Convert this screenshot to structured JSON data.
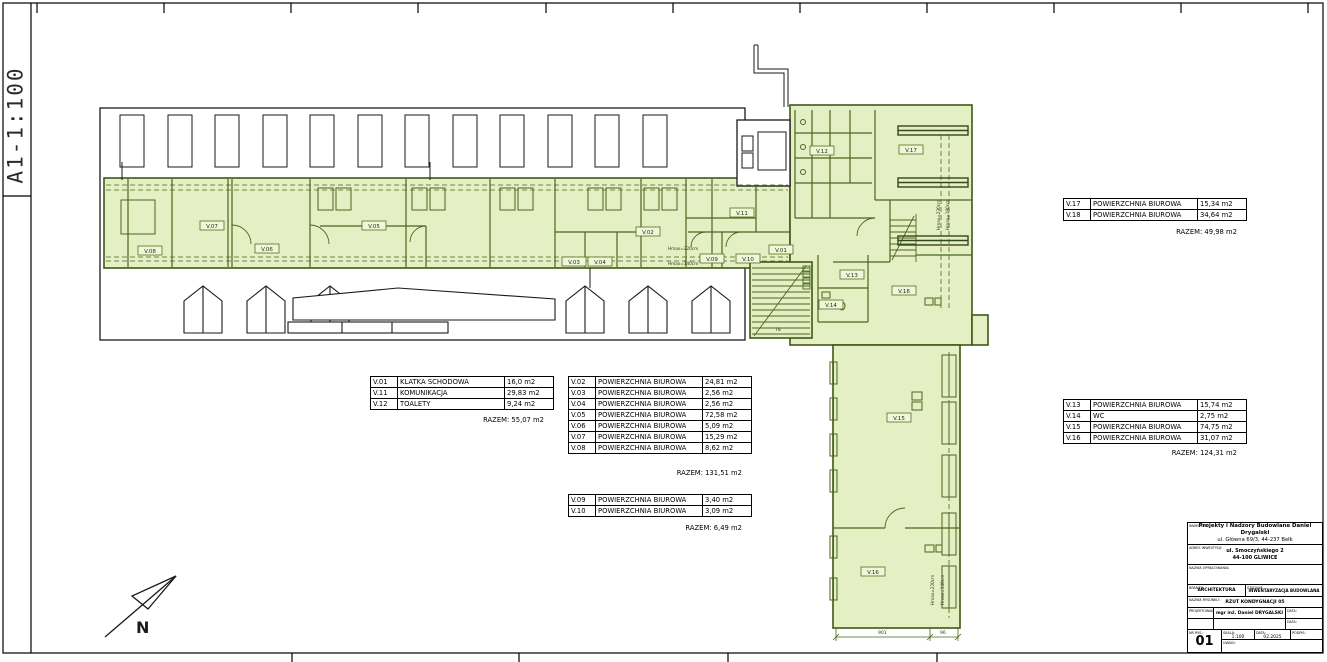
{
  "sheet": {
    "format_scale_label": "A1-1:100"
  },
  "plan": {
    "north_label": "N",
    "colors": {
      "room_fill": "#e5efc4",
      "plan_line": "#4a661e",
      "wall": "#1a1a1a"
    },
    "rooms": {
      "v01": "V.01",
      "v02": "V.02",
      "v03": "V.03",
      "v04": "V.04",
      "v05": "V.05",
      "v06": "V.06",
      "v07": "V.07",
      "v08": "V.08",
      "v09": "V.09",
      "v10": "V.10",
      "v11": "V.11",
      "v12": "V.12",
      "v13": "V.13",
      "v14": "V.14",
      "v15": "V.15",
      "v16": "V.16",
      "v17": "V.17",
      "v18": "V.18"
    },
    "annotations": {
      "h220": "Hmax=220cm",
      "h140": "Hmax=140cm",
      "h230": "Hmax=230cm",
      "h190": "Hmax=190cm"
    },
    "dimensions": {
      "stair_width": "78",
      "strip_bottom_main": "901",
      "strip_bottom_side": "96"
    }
  },
  "tables": {
    "t1": {
      "rows": [
        {
          "code": "V.01",
          "name": "KLATKA SCHODOWA",
          "area": "16,0 m2"
        },
        {
          "code": "V.11",
          "name": "KOMUNIKACJA",
          "area": "29,83 m2"
        },
        {
          "code": "V.12",
          "name": "TOALETY",
          "area": "9,24 m2"
        }
      ],
      "total": "RAZEM: 55,07 m2"
    },
    "t2": {
      "rows": [
        {
          "code": "V.02",
          "name": "POWIERZCHNIA BIUROWA",
          "area": "24,81 m2"
        },
        {
          "code": "V.03",
          "name": "POWIERZCHNIA BIUROWA",
          "area": "2,56 m2"
        },
        {
          "code": "V.04",
          "name": "POWIERZCHNIA BIUROWA",
          "area": "2,56 m2"
        },
        {
          "code": "V.05",
          "name": "POWIERZCHNIA BIUROWA",
          "area": "72,58 m2"
        },
        {
          "code": "V.06",
          "name": "POWIERZCHNIA BIUROWA",
          "area": "5,09 m2"
        },
        {
          "code": "V.07",
          "name": "POWIERZCHNIA BIUROWA",
          "area": "15,29 m2"
        },
        {
          "code": "V.08",
          "name": "POWIERZCHNIA BIUROWA",
          "area": "8,62 m2"
        }
      ],
      "total": "RAZEM: 131,51 m2"
    },
    "t3": {
      "rows": [
        {
          "code": "V.09",
          "name": "POWIERZCHNIA BIUROWA",
          "area": "3,40 m2"
        },
        {
          "code": "V.10",
          "name": "POWIERZCHNIA BIUROWA",
          "area": "3,09 m2"
        }
      ],
      "total": "RAZEM: 6,49 m2"
    },
    "t4": {
      "rows": [
        {
          "code": "V.17",
          "name": "POWIERZCHNIA BIUROWA",
          "area": "15,34 m2"
        },
        {
          "code": "V.18",
          "name": "POWIERZCHNIA BIUROWA",
          "area": "34,64 m2"
        }
      ],
      "total": "RAZEM: 49,98 m2"
    },
    "t5": {
      "rows": [
        {
          "code": "V.13",
          "name": "POWIERZCHNIA BIUROWA",
          "area": "15,74 m2"
        },
        {
          "code": "V.14",
          "name": "WC",
          "area": "2,75 m2"
        },
        {
          "code": "V.15",
          "name": "POWIERZCHNIA BIUROWA",
          "area": "74,75 m2"
        },
        {
          "code": "V.16",
          "name": "POWIERZCHNIA BIUROWA",
          "area": "31,07 m2"
        }
      ],
      "total": "RAZEM: 124,31 m2"
    }
  },
  "title_block": {
    "investor_label": "INWESTOR:",
    "investor_line1": "Projekty i Nadzory Budowlane Daniel Drygalski",
    "investor_line2": "ul. Główna 69/3, 44-237 Bełk",
    "address_label": "ADRES INWESTYCJI:",
    "address_line1": "ul. Smoczyńskiego 2",
    "address_line2": "44-100 GLIWICE",
    "unit_label": "NAZWA OPRACOWANIA:",
    "branch_label": "BRANŻA:",
    "branch_value": "ARCHITEKTURA",
    "stage_label": "STADIUM:",
    "stage_value": "INWENTARYZACJA BUDOWLANA",
    "drawing_label": "NAZWA RYSUNKU:",
    "drawing_value": "RZUT KONDYGNACJI 05",
    "designer_label": "PROJEKTOWAŁ:",
    "designer_value": "mgr inż. Daniel DRYGALSKI",
    "date_label": "DATA:",
    "sheet_no_label": "NR RYS.:",
    "sheet_no": "01",
    "scale_label": "SKALA:",
    "scale_value": "1:100",
    "date_value": "02.2025",
    "signature_label": "PODPIS:",
    "notes_label": "UWAGI:"
  }
}
